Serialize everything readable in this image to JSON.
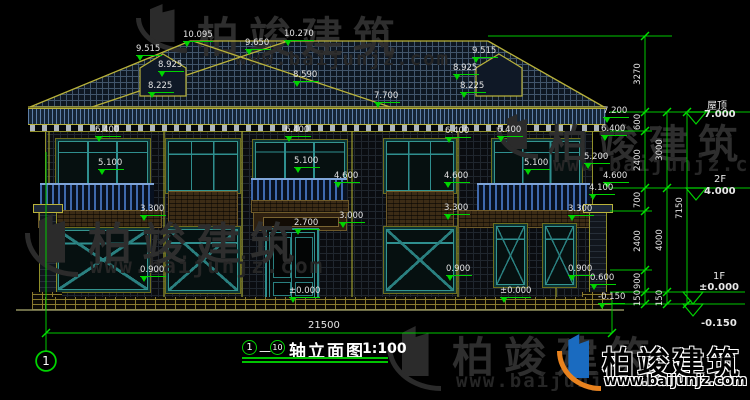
{
  "brand": {
    "name": "柏竣建筑",
    "website": "www.baijunjz.com"
  },
  "title_block": {
    "axis_start": "1",
    "axis_end": "10",
    "title": "轴立面图",
    "scale": "1:100"
  },
  "axis_bubble": {
    "label": "1"
  },
  "overall_dim": {
    "text": "21500"
  },
  "levels": [
    {
      "label": "屋顶",
      "value": "7.000",
      "label_x": 707,
      "label_y": 97,
      "value_x": 704,
      "value_y": 109
    },
    {
      "label": "2F",
      "value": "4.000",
      "label_x": 714,
      "label_y": 174,
      "value_x": 704,
      "value_y": 186
    },
    {
      "label": "1F",
      "value": "±0.000",
      "label_x": 713,
      "label_y": 271,
      "value_x": 699,
      "value_y": 282
    },
    {
      "label": "",
      "value": "-0.150",
      "label_x": 0,
      "label_y": 0,
      "value_x": 701,
      "value_y": 318
    }
  ],
  "dim_chains": [
    {
      "x": 645,
      "label_x": 638,
      "segments": [
        {
          "text": "3270",
          "y1": 36,
          "y2": 112
        },
        {
          "text": "600",
          "y1": 112,
          "y2": 131
        },
        {
          "text": "2400",
          "y1": 131,
          "y2": 188
        },
        {
          "text": "700",
          "y1": 188,
          "y2": 211
        },
        {
          "text": "2400",
          "y1": 211,
          "y2": 270
        },
        {
          "text": "900",
          "y1": 270,
          "y2": 292
        },
        {
          "text": "150",
          "y1": 292,
          "y2": 304
        }
      ]
    },
    {
      "x": 667,
      "label_x": 660,
      "segments": [
        {
          "text": "3000",
          "y1": 112,
          "y2": 188
        },
        {
          "text": "4000",
          "y1": 188,
          "y2": 292
        },
        {
          "text": "150",
          "y1": 292,
          "y2": 304
        }
      ]
    },
    {
      "x": 687,
      "label_x": 680,
      "segments": [
        {
          "text": "7150",
          "y1": 112,
          "y2": 304
        }
      ]
    }
  ],
  "annotations": [
    {
      "text": "10.095",
      "x": 183,
      "y": 31
    },
    {
      "text": "9.650",
      "x": 245,
      "y": 39
    },
    {
      "text": "10.270",
      "x": 284,
      "y": 30
    },
    {
      "text": "9.515",
      "x": 136,
      "y": 45
    },
    {
      "text": "8.925",
      "x": 158,
      "y": 61
    },
    {
      "text": "8.225",
      "x": 148,
      "y": 82
    },
    {
      "text": "8.590",
      "x": 293,
      "y": 71
    },
    {
      "text": "7.700",
      "x": 374,
      "y": 92
    },
    {
      "text": "9.515",
      "x": 472,
      "y": 47
    },
    {
      "text": "8.925",
      "x": 453,
      "y": 64
    },
    {
      "text": "8.225",
      "x": 460,
      "y": 82
    },
    {
      "text": "6.400",
      "x": 95,
      "y": 126
    },
    {
      "text": "5.100",
      "x": 98,
      "y": 159
    },
    {
      "text": "3.300",
      "x": 140,
      "y": 205
    },
    {
      "text": "0.900",
      "x": 140,
      "y": 266
    },
    {
      "text": "6.400",
      "x": 285,
      "y": 126
    },
    {
      "text": "5.100",
      "x": 294,
      "y": 157
    },
    {
      "text": "4.600",
      "x": 334,
      "y": 172
    },
    {
      "text": "3.000",
      "x": 339,
      "y": 212
    },
    {
      "text": "2.700",
      "x": 294,
      "y": 219
    },
    {
      "text": "±0.000",
      "x": 289,
      "y": 287
    },
    {
      "text": "6.400",
      "x": 445,
      "y": 127
    },
    {
      "text": "4.600",
      "x": 444,
      "y": 172
    },
    {
      "text": "3.300",
      "x": 444,
      "y": 204
    },
    {
      "text": "0.900",
      "x": 446,
      "y": 265
    },
    {
      "text": "±0.000",
      "x": 500,
      "y": 287
    },
    {
      "text": "6.400",
      "x": 497,
      "y": 126
    },
    {
      "text": "5.100",
      "x": 524,
      "y": 159
    },
    {
      "text": "7.200",
      "x": 603,
      "y": 107
    },
    {
      "text": "6.400",
      "x": 601,
      "y": 125
    },
    {
      "text": "5.200",
      "x": 584,
      "y": 153
    },
    {
      "text": "4.600",
      "x": 603,
      "y": 172
    },
    {
      "text": "4.100",
      "x": 589,
      "y": 184
    },
    {
      "text": "3.300",
      "x": 568,
      "y": 205
    },
    {
      "text": "0.900",
      "x": 568,
      "y": 265
    },
    {
      "text": "0.600",
      "x": 590,
      "y": 274
    },
    {
      "text": "-0.150",
      "x": 598,
      "y": 293
    }
  ]
}
